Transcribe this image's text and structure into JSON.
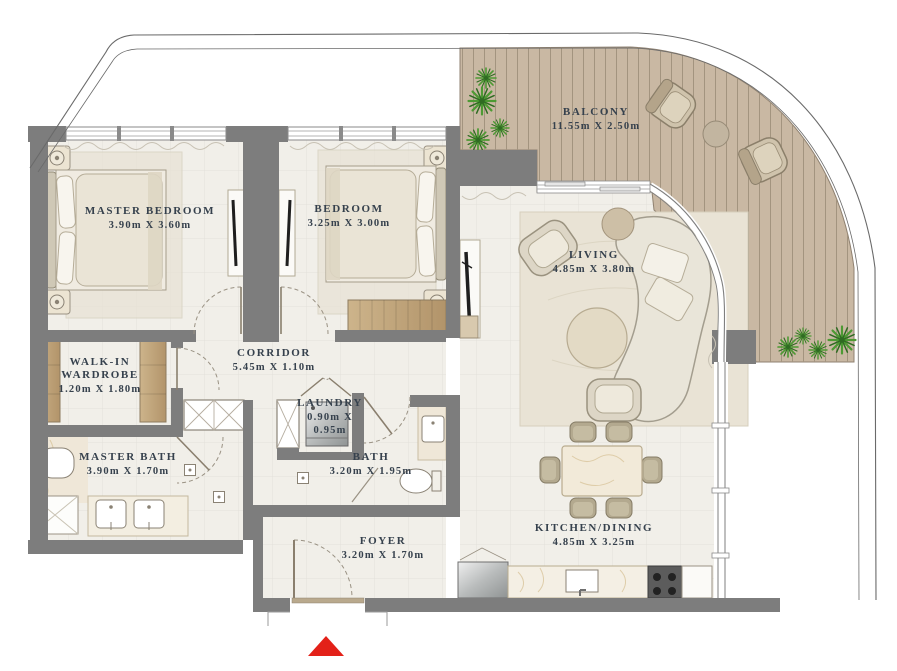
{
  "plan": {
    "title": "apartment-floor-plan",
    "rooms": [
      {
        "id": "master-bedroom",
        "name": "MASTER BEDROOM",
        "dimensions": "3.90m X 3.60m"
      },
      {
        "id": "bedroom",
        "name": "BEDROOM",
        "dimensions": "3.25m X 3.00m"
      },
      {
        "id": "balcony",
        "name": "BALCONY",
        "dimensions": "11.55m X 2.50m"
      },
      {
        "id": "living",
        "name": "LIVING",
        "dimensions": "4.85m X 3.80m"
      },
      {
        "id": "walk-in-wardrobe",
        "name": "WALK-IN WARDROBE",
        "dimensions": "1.20m X 1.80m"
      },
      {
        "id": "corridor",
        "name": "CORRIDOR",
        "dimensions": "5.45m X 1.10m"
      },
      {
        "id": "laundry",
        "name": "LAUNDRY",
        "dimensions": "0.90m X 0.95m"
      },
      {
        "id": "master-bath",
        "name": "MASTER BATH",
        "dimensions": "3.90m X 1.70m"
      },
      {
        "id": "bath",
        "name": "BATH",
        "dimensions": "3.20m X 1.95m"
      },
      {
        "id": "foyer",
        "name": "FOYER",
        "dimensions": "3.20m X 1.70m"
      },
      {
        "id": "kitchen-dining",
        "name": "KITCHEN/DINING",
        "dimensions": "4.85m X 3.25m"
      }
    ],
    "entrance_marker": {
      "shape": "triangle-up",
      "color": "#e32119"
    },
    "colors": {
      "wall": "#7d7d7d",
      "floor": "#f1efe9",
      "deck": "#c9b8a3",
      "deck_line": "#a3947f",
      "wood": "#c2a171",
      "label_text": "#36414d",
      "plant": "#4d9a33",
      "marble": "#efe7d8",
      "metal": "#c7c9c9"
    }
  }
}
